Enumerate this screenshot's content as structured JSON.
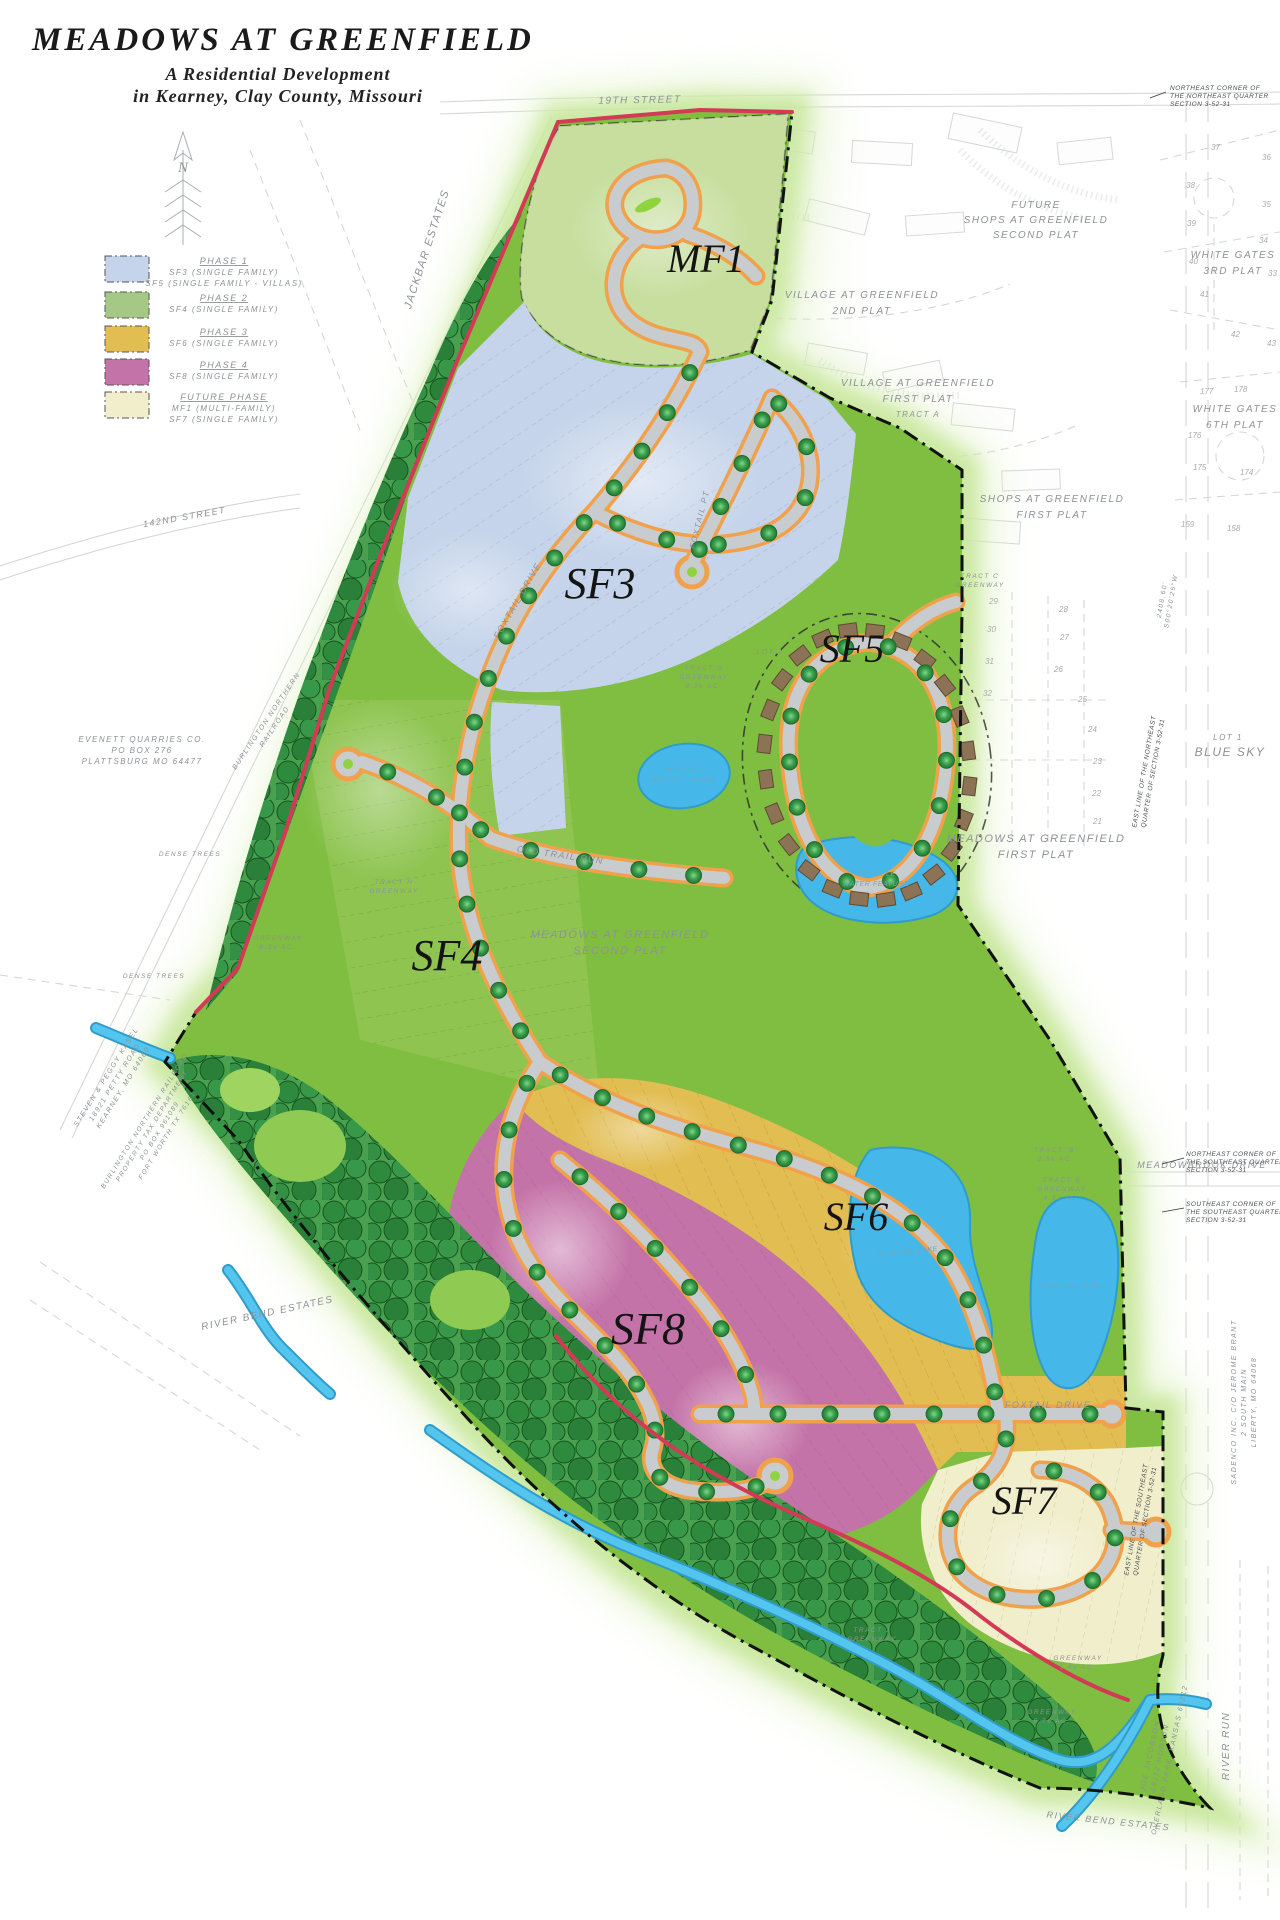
{
  "title_block": {
    "title": "MEADOWS AT GREENFIELD",
    "subtitle1": "A Residential Development",
    "subtitle2": "in Kearney, Clay County, Missouri"
  },
  "colors": {
    "site_green": "#7fbe41",
    "tree_green": "#2e8b3d",
    "water_blue": "#46b7e9",
    "road_gray": "#c9ccce",
    "road_edge_orange": "#f0a14b",
    "boundary_red": "#d23a55",
    "phase1_blue": "#c5d4ea",
    "phase2_green": "#a6c887",
    "phase3_gold": "#e2bd52",
    "phase4_pink": "#c473a8",
    "future_cream": "#f0eecb"
  },
  "legend": {
    "items": [
      {
        "swatch_color": "#c5d4ea",
        "phase": "PHASE 1",
        "lines": [
          "SF3 (SINGLE FAMILY)",
          "SF5 (SINGLE FAMILY - VILLAS)"
        ]
      },
      {
        "swatch_color": "#a6c887",
        "phase": "PHASE 2",
        "lines": [
          "SF4 (SINGLE FAMILY)"
        ]
      },
      {
        "swatch_color": "#e2bd52",
        "phase": "PHASE 3",
        "lines": [
          "SF6 (SINGLE FAMILY)"
        ]
      },
      {
        "swatch_color": "#c473a8",
        "phase": "PHASE 4",
        "lines": [
          "SF8 (SINGLE FAMILY)"
        ]
      },
      {
        "swatch_color": "#f0eecb",
        "phase": "FUTURE PHASE",
        "lines": [
          "MF1 (MULTI-FAMILY)",
          "SF7 (SINGLE FAMILY)"
        ]
      }
    ]
  },
  "map": {
    "north_label": "N",
    "phase_labels": {
      "mf1": "MF1",
      "sf3": "SF3",
      "sf4": "SF4",
      "sf5": "SF5",
      "sf6": "SF6",
      "sf7": "SF7",
      "sf8": "SF8"
    },
    "streets": {
      "s19th": "19TH STREET",
      "s142nd": "142ND STREET",
      "foxtail_nw": "FOXTAIL DRIVE",
      "foxtail_pt": "FOXTAIL PT",
      "old_trail_run": "OLD TRAIL RUN",
      "foxtail_se": "FOXTAIL DRIVE",
      "meadowbrook": "MEADOWBROOK DRIVE"
    },
    "neighbors": {
      "jackbar": "JACKBAR ESTATES",
      "village2": [
        "VILLAGE AT GREENFIELD",
        "2ND PLAT"
      ],
      "village1": [
        "VILLAGE AT GREENFIELD",
        "FIRST PLAT",
        "TRACT A"
      ],
      "future_shops": [
        "FUTURE",
        "SHOPS AT GREENFIELD",
        "SECOND PLAT"
      ],
      "shops1": [
        "SHOPS AT GREENFIELD",
        "FIRST PLAT"
      ],
      "wg3": [
        "WHITE GATES",
        "3RD PLAT"
      ],
      "wg6": [
        "WHITE GATES",
        "6TH PLAT"
      ],
      "bluesky": [
        "LOT 1",
        "BLUE SKY"
      ],
      "mg1": [
        "MEADOWS AT GREENFIELD",
        "FIRST PLAT"
      ],
      "mg2": [
        "MEADOWS AT GREENFIELD",
        "SECOND PLAT"
      ],
      "rbe_w": "RIVER BEND ESTATES",
      "rbe_s": "RIVER BEND ESTATES",
      "river_run": "RIVER RUN"
    },
    "water": {
      "pwf1": [
        "POSSIBLE",
        "WATER FEATURE"
      ],
      "pwf2": [
        "POSSIBLE",
        "WATER FEATURE"
      ],
      "existing_lake": "EXISTING LAKE",
      "proposed_lake": "PROPOSED LAKE"
    },
    "greenways": {
      "tract_g": [
        "TRACT G",
        "GREENWAY",
        "9.2± AC."
      ],
      "tract_c": [
        "TRACT C",
        "GREENWAY"
      ],
      "tract_b": [
        "TRACT B",
        "GREENWAY",
        "4.3± AC."
      ],
      "tract_b2": [
        "TRACT 'B'",
        "0.5± AC."
      ],
      "tract_h": [
        "TRACT H",
        "GREENWAY"
      ],
      "tract_j": [
        "TRACT J",
        "GREENWAY"
      ],
      "gw83": [
        "GREENWAY",
        "8.3± AC."
      ],
      "gw57": [
        "GREENWAY",
        "5.7± AC."
      ],
      "gw14": [
        "GREENWAY",
        "1.4± AC."
      ]
    },
    "owners": {
      "evenett": [
        "EVENETT QUARRIES CO.",
        "PO BOX 276",
        "PLATTSBURG MO 64477"
      ],
      "kasel": [
        "STEVEN & PEGGY KASEL",
        "18921 PETTY ROAD",
        "KEARNEY, MO 64060"
      ],
      "bnr": [
        "BURLINGTON NORTHERN",
        "RAILROAD"
      ],
      "bnr_tax": [
        "BURLINGTON NORTHERN RAILROAD",
        "PROPERTY TAX DEPARTMENT",
        "PO BOX 961089",
        "FORT WORTH TX 76161"
      ],
      "jacobson": [
        "JOE JACOBSON",
        "18112 HORTON",
        "OVERLAND PARK, KANSAS 66212"
      ],
      "sadenco": [
        "SADENCO INC. C/O JEROME BRANT",
        "2 SOUTH MAIN",
        "LIBERTY, MO 64068"
      ]
    },
    "survey_notes": {
      "ne_ne": [
        "NORTHEAST CORNER OF",
        "THE NORTHEAST QUARTER",
        "SECTION 3-52-31"
      ],
      "east_line_ne": [
        "EAST LINE OF THE NORTHEAST",
        "QUARTER OF SECTION 3-52-31"
      ],
      "bearing": [
        "2408.60'",
        "S00°20'25\"W"
      ],
      "ne_se": [
        "NORTHEAST CORNER OF",
        "THE SOUTHEAST QUARTER",
        "SECTION 3-52-31"
      ],
      "se_se": [
        "SOUTHEAST CORNER OF",
        "THE SOUTHEAST QUARTER",
        "SECTION 3-52-31"
      ],
      "east_line_se": [
        "EAST LINE OF THE SOUTHEAST",
        "QUARTER OF SECTION 3-52-31"
      ],
      "dense_trees_1": "DENSE TREES",
      "dense_trees_2": "DENSE TREES"
    },
    "misc": {
      "lot1_sf5": "LOT 1"
    },
    "offsite_lots": {
      "white_gates": [
        {
          "n": "37"
        },
        {
          "n": "36"
        },
        {
          "n": "38"
        },
        {
          "n": "35"
        },
        {
          "n": "39"
        },
        {
          "n": "34"
        },
        {
          "n": "40"
        },
        {
          "n": "33"
        },
        {
          "n": "41"
        },
        {
          "n": "42"
        },
        {
          "n": "43"
        },
        {
          "n": "178"
        },
        {
          "n": "177"
        },
        {
          "n": "176"
        },
        {
          "n": "175"
        },
        {
          "n": "174"
        },
        {
          "n": "159"
        },
        {
          "n": "158"
        }
      ],
      "meadows_first": [
        {
          "n": "29"
        },
        {
          "n": "28"
        },
        {
          "n": "30"
        },
        {
          "n": "27"
        },
        {
          "n": "31"
        },
        {
          "n": "26"
        },
        {
          "n": "32"
        },
        {
          "n": "25"
        },
        {
          "n": "24"
        },
        {
          "n": "23"
        },
        {
          "n": "22"
        },
        {
          "n": "21"
        }
      ]
    }
  }
}
